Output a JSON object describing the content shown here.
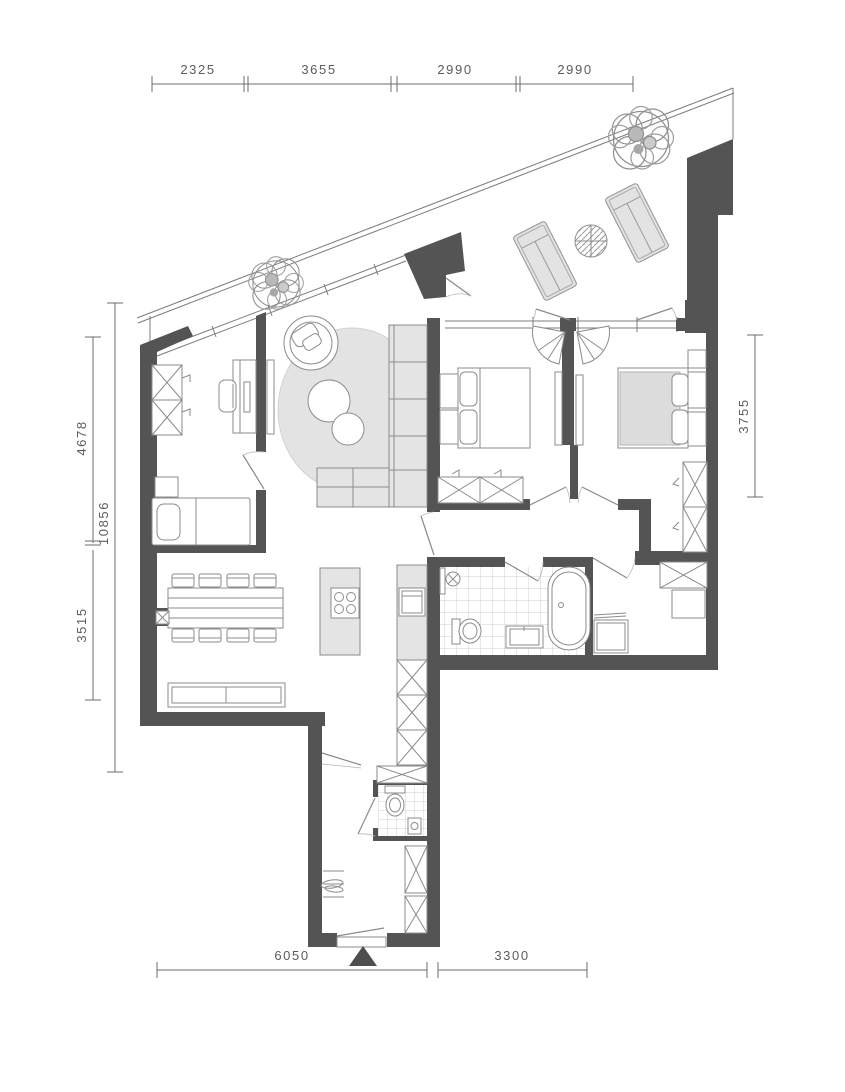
{
  "plan_title": "apartment-floor-plan",
  "dims": {
    "top": [
      "2325",
      "3655",
      "2990",
      "2990"
    ],
    "left_overall": "10856",
    "left_upper": "4678",
    "left_lower": "3515",
    "right_side": "3755",
    "bottom": [
      "6050",
      "3300"
    ]
  },
  "colors": {
    "wall": "#545454",
    "furniture_fill": "#e4e4e4",
    "rug_fill": "#e3e3e3",
    "duvet_fill": "#dcdcdc",
    "outline": "#8b8b8b",
    "dimension_text": "#5c5c5c",
    "tile_line": "#d0d0d0",
    "background": "#ffffff"
  },
  "icons": {
    "entrance_marker": "entrance-triangle-icon",
    "cooktop": "cooktop-icon",
    "shower": "shower-head-icon",
    "plant": "plant-icon"
  }
}
